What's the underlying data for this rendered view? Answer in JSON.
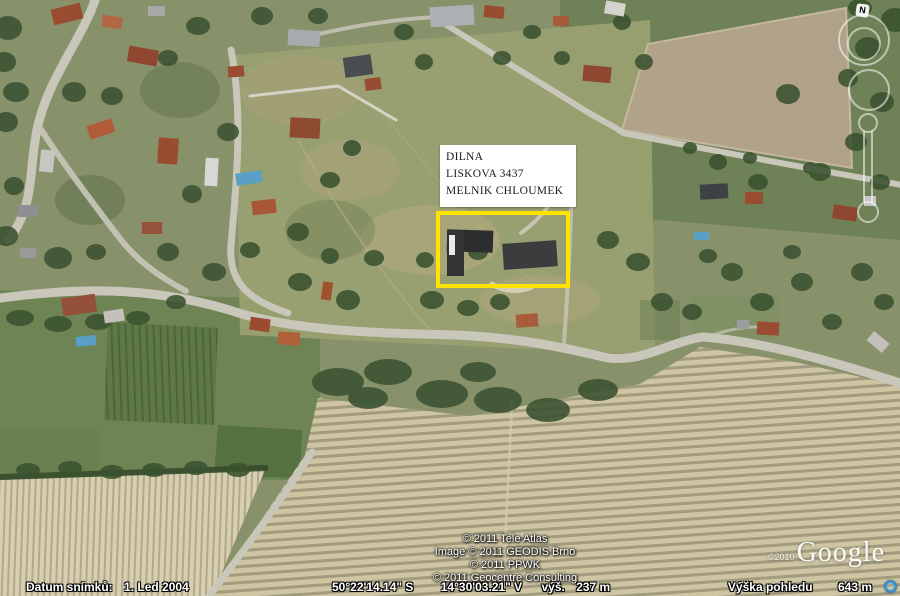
{
  "map": {
    "property_label": {
      "lines": [
        "DILNA",
        "LISKOVA 3437",
        "MELNIK CHLOUMEK"
      ]
    },
    "nav": {
      "compass": "N"
    },
    "attribution": {
      "lines": [
        "© 2011 Tele Atlas",
        "Image © 2011 GEODIS Brno",
        "© 2011 PPWK",
        "© 2011 Geocentre Consulting"
      ]
    },
    "branding": {
      "copyright": "©2010",
      "logo": "Google"
    },
    "status": {
      "date_label": "Datum snímků:",
      "date_value": "1. Led 2004",
      "lat": "50°22'14.14\" S",
      "lon": "14°30'03.21\" V",
      "alt_label": "výš.",
      "alt_value": "237 m",
      "eye_label": "Výška pohledu",
      "eye_value": "643 m"
    },
    "colors": {
      "highlight": "#ffe400",
      "label_box_bg": "#ffffff"
    }
  }
}
